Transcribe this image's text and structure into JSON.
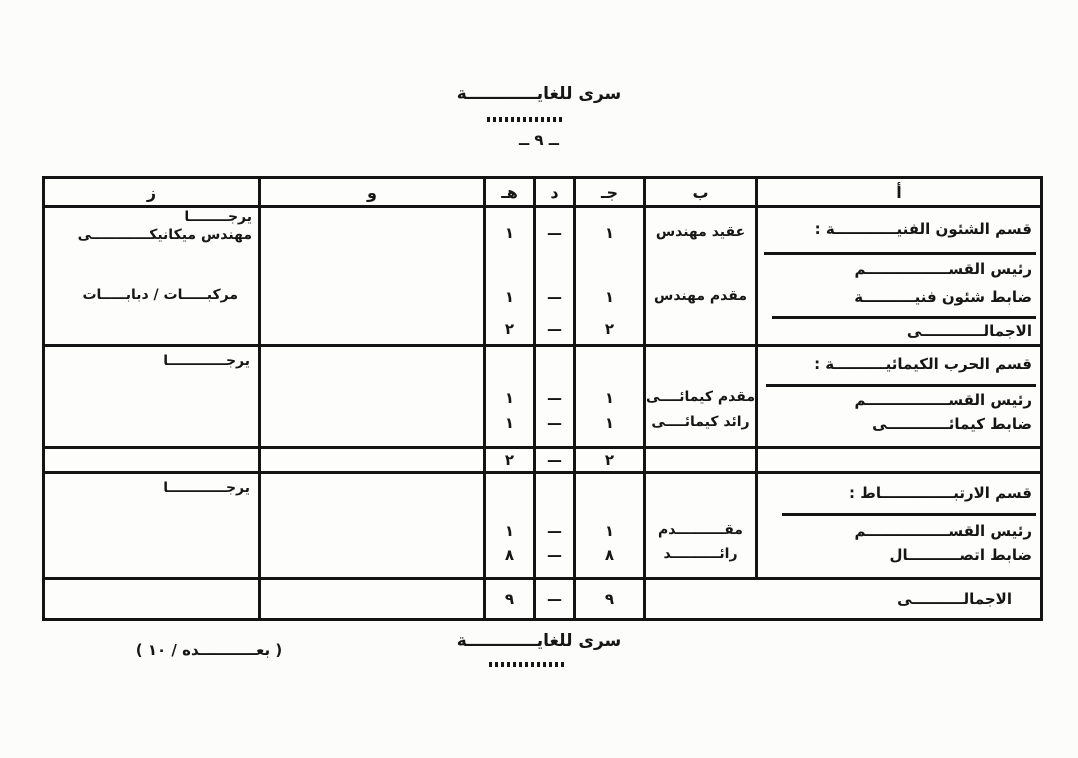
{
  "header": {
    "classification": "سرى للغايــــــــــــة",
    "page_number": "ــ ٩ ــ"
  },
  "footer": {
    "classification": "سرى للغايــــــــــــة",
    "continuation": "( بعـــــــــــده / ١٠ )"
  },
  "table": {
    "cols": {
      "a": "أ",
      "b": "ب",
      "c": "جـ",
      "d": "د",
      "e": "هـ",
      "f": "و",
      "g": "ز"
    },
    "s1": {
      "title": "قسم الشئون الفنيــــــــــــة :",
      "post1": "رئيس القســــــــــــــــم",
      "post2": "ضابط شئون فنيــــــــــة",
      "total_label": "الاجمالــــــــــــى",
      "rank1": "عقيد مهندس",
      "rank2": "مقدم مهندس",
      "c1": "١",
      "d1": "—",
      "e1": "١",
      "c2": "١",
      "d2": "—",
      "e2": "١",
      "ct": "٢",
      "dt": "—",
      "et": "٢",
      "z1": "يرجــــــــا",
      "z2": "مهندس ميكانيكــــــــــــى",
      "z3": "مركبـــــات / دبابـــــات"
    },
    "s2": {
      "title": "قسم الحرب الكيمائيــــــــــة :",
      "post1": "رئيس القســــــــــــــــم",
      "post2": "ضابط كيمائــــــــــــى",
      "rank1": "مقدم كيمائــــى",
      "rank2": "رائد كيمائــــى",
      "c1": "١",
      "d1": "—",
      "e1": "١",
      "c2": "١",
      "d2": "—",
      "e2": "١",
      "z": "يرجــــــــــــا"
    },
    "s2_total": {
      "c": "٢",
      "d": "—",
      "e": "٢"
    },
    "s3": {
      "title": "قسم الارتبــــــــــــــاط :",
      "post1": "رئيس القســــــــــــــــم",
      "post2": "ضابط اتصــــــــــال",
      "rank1": "مقــــــــــدم",
      "rank2": "رائــــــــــد",
      "c1": "١",
      "d1": "—",
      "e1": "١",
      "c2": "٨",
      "d2": "—",
      "e2": "٨",
      "z": "يرجــــــــــــا"
    },
    "grand_total": {
      "label": "الاجمالــــــــــى",
      "c": "٩",
      "d": "—",
      "e": "٩"
    }
  }
}
